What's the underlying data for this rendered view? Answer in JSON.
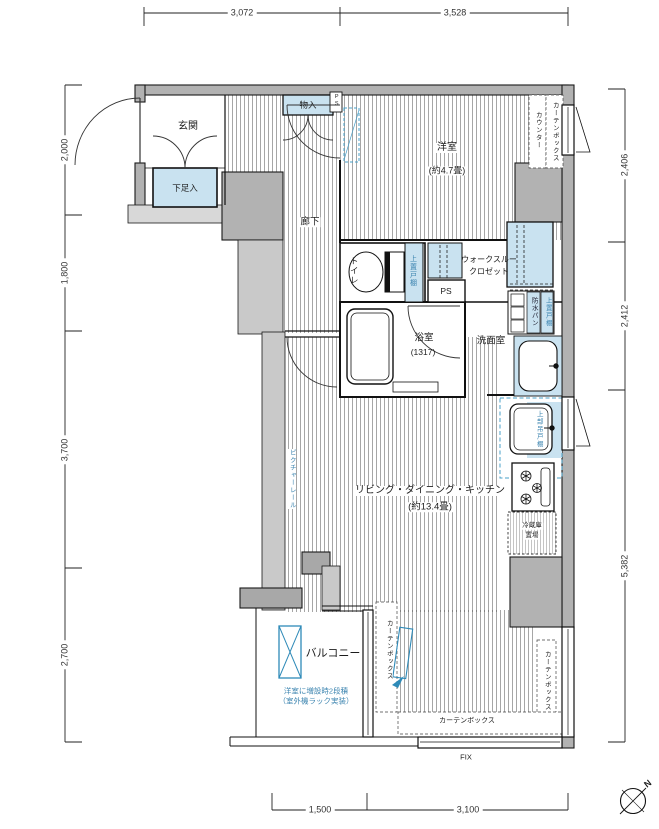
{
  "dimensions": {
    "top": [
      "3,072",
      "3,528"
    ],
    "left": [
      "2,000",
      "1,800",
      "3,700",
      "2,700"
    ],
    "right": [
      "2,406",
      "2,412",
      "5,382"
    ],
    "bottom": [
      "1,500",
      "3,100"
    ]
  },
  "rooms": {
    "entrance": "玄関",
    "shoe_box": "下足入",
    "closet_top": "物入",
    "corridor": "廊下",
    "bedroom": "洋室",
    "bedroom_size": "(約4.7畳)",
    "toilet": "トイレ",
    "wtc_line1": "ウォークスルー",
    "wtc_line2": "クロゼット",
    "ps": "PS",
    "ps_shaft": "PS",
    "bath": "浴室",
    "bath_size": "(1317)",
    "washroom": "洗面室",
    "ldk": "リビング・ダイニング・キッチン",
    "ldk_size": "(約13.4畳)",
    "balcony": "バルコニー",
    "fridge_line1": "冷蔵庫",
    "fridge_line2": "置場"
  },
  "labels": {
    "counter": "カウンター",
    "curtain_box": "カーテンボックス",
    "upper_cabinet": "上置戸棚",
    "waterproof_pan": "防水パン",
    "hanging_cabinet": "上部吊戸棚",
    "picture_rail": "ピクチャーレール",
    "balcony_note1": "洋室に増設時2段積",
    "balcony_note2": "（室外機ラック実装）",
    "fix": "FIX",
    "north": "N"
  },
  "colors": {
    "fixture_blue": "#c9e2f0",
    "wall_gray": "#b2b2b2",
    "light_gray": "#c9c9c9",
    "annotation_blue": "#3d85b0",
    "dashed_blue": "#4aa0c8"
  }
}
